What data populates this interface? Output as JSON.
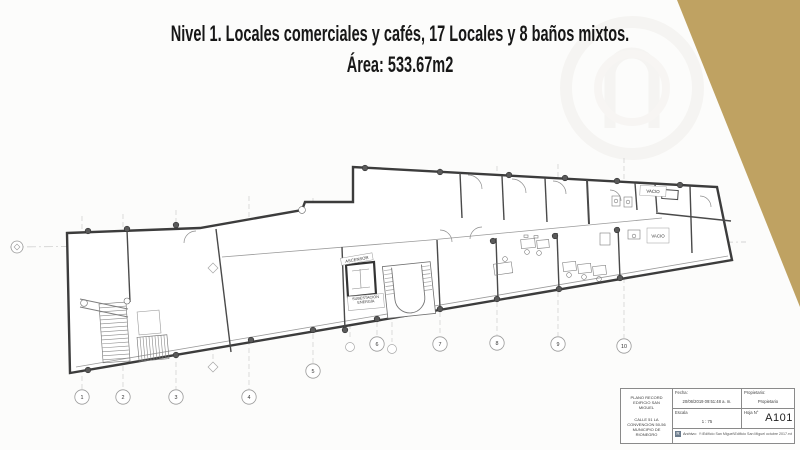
{
  "slide": {
    "title_line1": "Nivel 1. Locales comerciales y cafés, 17 Locales y 8 baños mixtos.",
    "title_line2": "Área: 533.67m2",
    "accent_color": "#bfa262"
  },
  "plan": {
    "labels": {
      "ascensor": "ASCENSOR",
      "subestacion": "SUBESTACIÓN\nENERGÍA",
      "vacio_top": "VACIO",
      "vacio_right": "VACIO"
    },
    "grid_labels": [
      "1",
      "2",
      "3",
      "4",
      "5",
      "6",
      "7",
      "8",
      "9",
      "10"
    ]
  },
  "title_block": {
    "project_name": "PLANO RECORD\nEDIFICIO SAN\nMIGUEL",
    "project_address": "CALLE 51 LA\nCONVENCION 50-56\nMUNICIPIO DE\nRIONEGRO",
    "fecha_label": "Fecha:",
    "fecha_value": "20/06/2019 09:51:48 a. m.",
    "propietario_label": "Propietario:",
    "propietario_value": "Propietario",
    "escala_label": "Escala",
    "escala_value": "1 : 75",
    "hoja_label": "Hoja N°",
    "hoja_value": "A101",
    "archivo_label": "Archivo:",
    "archivo_value": "Y:\\Edificio San Miguel\\Edificio San Miguel octubre 2017.rvt",
    "revit_icon_letter": "R"
  }
}
